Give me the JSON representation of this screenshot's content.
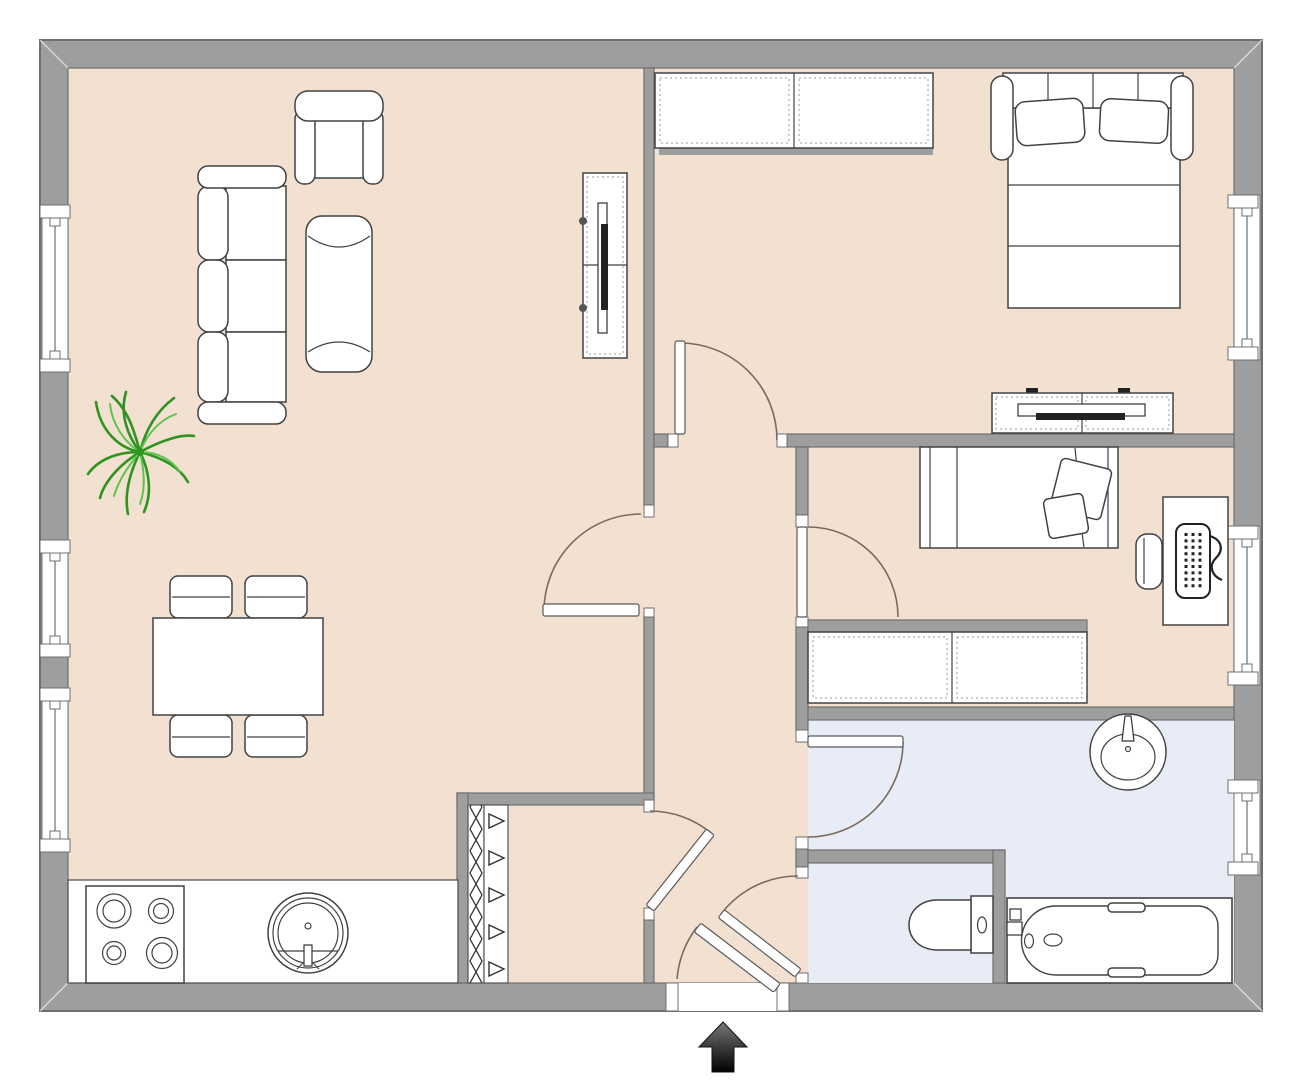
{
  "title": "Two-bedroom apartment floor plan",
  "colors": {
    "wall_fill": "#9E9E9E",
    "wall_stroke": "#6F6F6F",
    "floor_main": "#F2E0D0",
    "floor_bath": "#E8ECF6",
    "furniture_fill": "#FFFFFF",
    "furniture_stroke": "#424242",
    "door_arc": "#7B6A5B",
    "plant_dark": "#2E9320",
    "plant_light": "#5CC44E",
    "arrow_dark": "#1A1A1A"
  },
  "rooms": [
    {
      "id": "living-room",
      "symbol": "open living / dining room with kitchen strip",
      "floor": "beige"
    },
    {
      "id": "bedroom-main",
      "symbol": "bedroom with double bed",
      "floor": "beige"
    },
    {
      "id": "bedroom-second",
      "symbol": "second bedroom with single bed and desk",
      "floor": "beige"
    },
    {
      "id": "hallway",
      "symbol": "entrance hall",
      "floor": "beige"
    },
    {
      "id": "closet",
      "symbol": "storage closet with radiator coil",
      "floor": "beige"
    },
    {
      "id": "bathroom",
      "symbol": "bathroom with washbasin and bathtub",
      "floor": "light-blue"
    },
    {
      "id": "wc",
      "symbol": "separate toilet room",
      "floor": "light-blue"
    }
  ],
  "furniture_symbols": [
    "three-seat-sofa",
    "armchair",
    "chaise-lounge",
    "potted-plant",
    "dining-table",
    "dining-chair x4",
    "tv-cabinet-living-room",
    "kitchen-counter",
    "stove-4-burners",
    "kitchen-round-sink",
    "radiator-zigzag",
    "wardrobe-2-door",
    "double-bed-with-pillows",
    "tv-dresser-bedroom",
    "single-bed-with-pillows",
    "desk-with-computer",
    "desk-chair",
    "sideboard-2-section",
    "washbasin-round",
    "toilet",
    "bathtub",
    "entrance-arrow"
  ],
  "windows": {
    "left_wall": 3,
    "right_wall": 3,
    "style": "white recess with center line and end caps"
  },
  "doors": {
    "interior_swing": 5,
    "entrance": 1,
    "wc": 1,
    "style": "arc with leaf"
  },
  "entrance": {
    "symbol": "arrow",
    "direction": "up",
    "position": "bottom-center"
  }
}
